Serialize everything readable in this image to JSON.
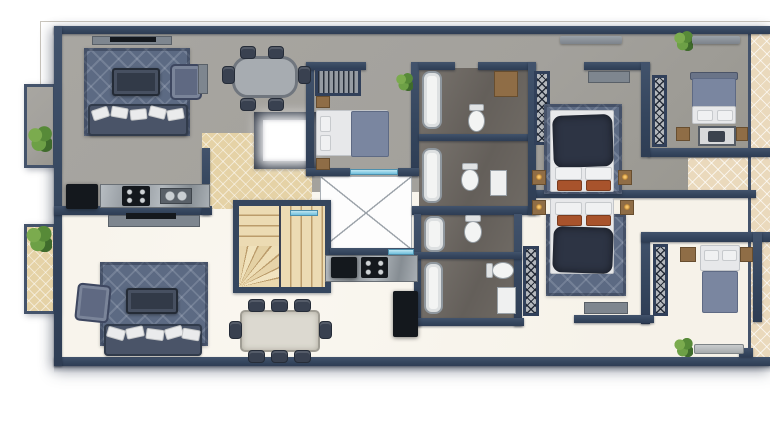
{
  "scene": {
    "type": "architectural-floor-plan",
    "view": "top-down-2d-render",
    "units": [
      {
        "id": "upper-apartment",
        "floor_finish": "gray",
        "rooms": [
          "living-room",
          "dining-area",
          "kitchen",
          "entry-foyer",
          "bedroom",
          "master-bedroom",
          "corner-bedroom",
          "bathroom-1",
          "bathroom-2",
          "balcony-left",
          "balcony-right"
        ]
      },
      {
        "id": "lower-apartment",
        "floor_finish": "cream",
        "rooms": [
          "living-room",
          "dining-area",
          "kitchen",
          "master-bedroom",
          "corner-bedroom",
          "bathroom-1",
          "bathroom-2",
          "balcony-left",
          "balcony-right"
        ]
      }
    ],
    "core": [
      "winder-staircase",
      "elevator-cab",
      "open-shaft-x"
    ],
    "furniture": [
      "sofa",
      "armchair",
      "coffee-table",
      "tv-console",
      "dining-table",
      "dining-chair",
      "double-bed",
      "single-bed",
      "nightstand",
      "table-lamp",
      "wardrobe-hatched",
      "open-closet-hangers",
      "bathtub",
      "toilet",
      "washbasin",
      "kitchen-counter",
      "cooktop",
      "refrigerator",
      "potted-plant",
      "vanity-desk",
      "ac-unit",
      "bench"
    ]
  },
  "colors": {
    "wall": "#35465e",
    "floor-upper": "#a3a19c",
    "floor-lower": "#f6f2e9",
    "entry-tile": "#e5d2a6",
    "tile-cream": "#ead9bc",
    "stair-wood": "#ecdbb3",
    "stair-edge": "#bb9c6b",
    "rug": "#5c6a83",
    "sofa": "#4a5468",
    "cushion": "#eaebec",
    "bath-floor": "#645f5a",
    "fixture": "#f3f4f3",
    "glass": "#6fc0dd",
    "plant-green": "#4e7d36",
    "appliance": "#14181d",
    "wood": "#8f6d46",
    "bed-navy": "#2d3444",
    "bed-slate": "#7a86a0",
    "mattress": "#e7e8ea",
    "pillow-rust": "#a8532c",
    "console": "#7e868f",
    "elevator-frame": "#2a3240",
    "void-line": "#9aa1a8",
    "outline": "#c9c5bd"
  }
}
